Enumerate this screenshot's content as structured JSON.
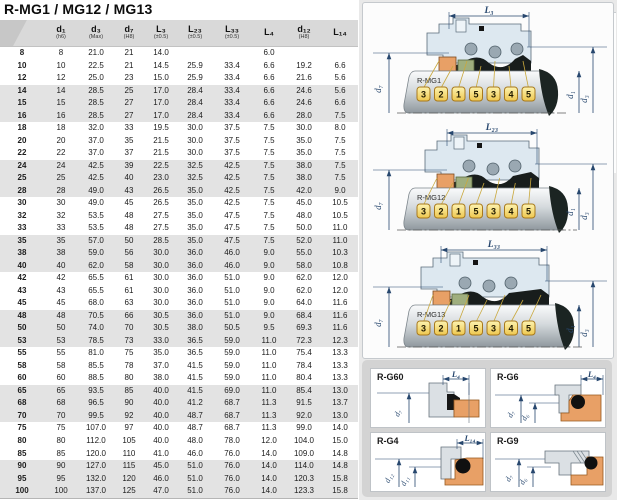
{
  "title": "R-MG1 / MG12 / MG13",
  "table": {
    "header": [
      {
        "label": "",
        "tol": ""
      },
      {
        "label": "d₁",
        "tol": "(h6)"
      },
      {
        "label": "d₃",
        "tol": "(Max)"
      },
      {
        "label": "d₇",
        "tol": "(H8)"
      },
      {
        "label": "L₃",
        "tol": "(±0.5)"
      },
      {
        "label": "L₂₃",
        "tol": "(±0.5)"
      },
      {
        "label": "L₃₃",
        "tol": "(±0.5)"
      },
      {
        "label": "L₄",
        "tol": ""
      },
      {
        "label": "d₁₂",
        "tol": "(H8)"
      },
      {
        "label": "L₁₄",
        "tol": ""
      }
    ],
    "rows": [
      [
        "8",
        "8",
        "21.0",
        "21",
        "14.0",
        "",
        "",
        "6.0",
        "",
        ""
      ],
      [
        "10",
        "10",
        "22.5",
        "21",
        "14.5",
        "25.9",
        "33.4",
        "6.6",
        "19.2",
        "6.6"
      ],
      [
        "12",
        "12",
        "25.0",
        "23",
        "15.0",
        "25.9",
        "33.4",
        "6.6",
        "21.6",
        "5.6"
      ],
      [
        "14",
        "14",
        "28.5",
        "25",
        "17.0",
        "28.4",
        "33.4",
        "6.6",
        "24.6",
        "5.6"
      ],
      [
        "15",
        "15",
        "28.5",
        "27",
        "17.0",
        "28.4",
        "33.4",
        "6.6",
        "24.6",
        "6.6"
      ],
      [
        "16",
        "16",
        "28.5",
        "27",
        "17.0",
        "28.4",
        "33.4",
        "6.6",
        "28.0",
        "7.5"
      ],
      [
        "18",
        "18",
        "32.0",
        "33",
        "19.5",
        "30.0",
        "37.5",
        "7.5",
        "30.0",
        "8.0"
      ],
      [
        "20",
        "20",
        "37.0",
        "35",
        "21.5",
        "30.0",
        "37.5",
        "7.5",
        "35.0",
        "7.5"
      ],
      [
        "22",
        "22",
        "37.0",
        "37",
        "21.5",
        "30.0",
        "37.5",
        "7.5",
        "35.0",
        "7.5"
      ],
      [
        "24",
        "24",
        "42.5",
        "39",
        "22.5",
        "32.5",
        "42.5",
        "7.5",
        "38.0",
        "7.5"
      ],
      [
        "25",
        "25",
        "42.5",
        "40",
        "23.0",
        "32.5",
        "42.5",
        "7.5",
        "38.0",
        "7.5"
      ],
      [
        "28",
        "28",
        "49.0",
        "43",
        "26.5",
        "35.0",
        "42.5",
        "7.5",
        "42.0",
        "9.0"
      ],
      [
        "30",
        "30",
        "49.0",
        "45",
        "26.5",
        "35.0",
        "42.5",
        "7.5",
        "45.0",
        "10.5"
      ],
      [
        "32",
        "32",
        "53.5",
        "48",
        "27.5",
        "35.0",
        "47.5",
        "7.5",
        "48.0",
        "10.5"
      ],
      [
        "33",
        "33",
        "53.5",
        "48",
        "27.5",
        "35.0",
        "47.5",
        "7.5",
        "50.0",
        "11.0"
      ],
      [
        "35",
        "35",
        "57.0",
        "50",
        "28.5",
        "35.0",
        "47.5",
        "7.5",
        "52.0",
        "11.0"
      ],
      [
        "38",
        "38",
        "59.0",
        "56",
        "30.0",
        "36.0",
        "46.0",
        "9.0",
        "55.0",
        "10.3"
      ],
      [
        "40",
        "40",
        "62.0",
        "58",
        "30.0",
        "36.0",
        "46.0",
        "9.0",
        "58.0",
        "10.8"
      ],
      [
        "42",
        "42",
        "65.5",
        "61",
        "30.0",
        "36.0",
        "51.0",
        "9.0",
        "62.0",
        "12.0"
      ],
      [
        "43",
        "43",
        "65.5",
        "61",
        "30.0",
        "36.0",
        "51.0",
        "9.0",
        "62.0",
        "12.0"
      ],
      [
        "45",
        "45",
        "68.0",
        "63",
        "30.0",
        "36.0",
        "51.0",
        "9.0",
        "64.0",
        "11.6"
      ],
      [
        "48",
        "48",
        "70.5",
        "66",
        "30.5",
        "36.0",
        "51.0",
        "9.0",
        "68.4",
        "11.6"
      ],
      [
        "50",
        "50",
        "74.0",
        "70",
        "30.5",
        "38.0",
        "50.5",
        "9.5",
        "69.3",
        "11.6"
      ],
      [
        "53",
        "53",
        "78.5",
        "73",
        "33.0",
        "36.5",
        "59.0",
        "11.0",
        "72.3",
        "12.3"
      ],
      [
        "55",
        "55",
        "81.0",
        "75",
        "35.0",
        "36.5",
        "59.0",
        "11.0",
        "75.4",
        "13.3"
      ],
      [
        "58",
        "58",
        "85.5",
        "78",
        "37.0",
        "41.5",
        "59.0",
        "11.0",
        "78.4",
        "13.3"
      ],
      [
        "60",
        "60",
        "88.5",
        "80",
        "38.0",
        "41.5",
        "59.0",
        "11.0",
        "80.4",
        "13.3"
      ],
      [
        "65",
        "65",
        "93.5",
        "85",
        "40.0",
        "41.5",
        "69.0",
        "11.0",
        "85.4",
        "13.0"
      ],
      [
        "68",
        "68",
        "96.5",
        "90",
        "40.0",
        "41.2",
        "68.7",
        "11.3",
        "91.5",
        "13.7"
      ],
      [
        "70",
        "70",
        "99.5",
        "92",
        "40.0",
        "48.7",
        "68.7",
        "11.3",
        "92.0",
        "13.0"
      ],
      [
        "75",
        "75",
        "107.0",
        "97",
        "40.0",
        "48.7",
        "68.7",
        "11.3",
        "99.0",
        "14.0"
      ],
      [
        "80",
        "80",
        "112.0",
        "105",
        "40.0",
        "48.0",
        "78.0",
        "12.0",
        "104.0",
        "15.0"
      ],
      [
        "85",
        "85",
        "120.0",
        "110",
        "41.0",
        "46.0",
        "76.0",
        "14.0",
        "109.0",
        "14.8"
      ],
      [
        "90",
        "90",
        "127.0",
        "115",
        "45.0",
        "51.0",
        "76.0",
        "14.0",
        "114.0",
        "14.8"
      ],
      [
        "95",
        "95",
        "132.0",
        "120",
        "46.0",
        "51.0",
        "76.0",
        "14.0",
        "120.3",
        "15.8"
      ],
      [
        "100",
        "100",
        "137.0",
        "125",
        "47.0",
        "51.0",
        "76.0",
        "14.0",
        "123.3",
        "15.8"
      ]
    ]
  },
  "seal_diagrams": [
    {
      "label": "R-MG1",
      "length_dim": "L₃",
      "left_dim": "d₇",
      "right_dims": [
        "d₁",
        "d₃"
      ],
      "part_numbers": [
        "3",
        "2",
        "1",
        "5",
        "3",
        "4",
        "5"
      ]
    },
    {
      "label": "R-MG12",
      "length_dim": "L₂₃",
      "left_dim": "d₇",
      "right_dims": [
        "d₁",
        "d₃"
      ],
      "part_numbers": [
        "3",
        "2",
        "1",
        "5",
        "3",
        "4",
        "5"
      ]
    },
    {
      "label": "R-MG13",
      "length_dim": "L₃₃",
      "left_dim": "d₇",
      "right_dims": [
        "d₁",
        "d₃"
      ],
      "part_numbers": [
        "3",
        "2",
        "1",
        "5",
        "3",
        "4",
        "5"
      ]
    }
  ],
  "detail_diagrams": [
    {
      "label": "R-G60",
      "length_dim": "L₄",
      "diameter_dims": [
        "d₇"
      ]
    },
    {
      "label": "R-G6",
      "length_dim": "L₄",
      "diameter_dims": [
        "d₇",
        "d₆"
      ]
    },
    {
      "label": "R-G4",
      "length_dim": "L₁₄",
      "diameter_dims": [
        "d₁₂",
        "d₁₁"
      ]
    },
    {
      "label": "R-G9",
      "length_dim": "",
      "diameter_dims": [
        "d₇",
        "d₆"
      ]
    }
  ],
  "colors": {
    "dimension_blue": "#27476e",
    "housing_fill": "#dde8f0",
    "plate_border": "#a8791c",
    "elastomer_orange": "#e8a066",
    "ring_olive": "#9fae7e",
    "row_stripe": "#e3e3e3",
    "header_bg": "#d9d9d9"
  }
}
